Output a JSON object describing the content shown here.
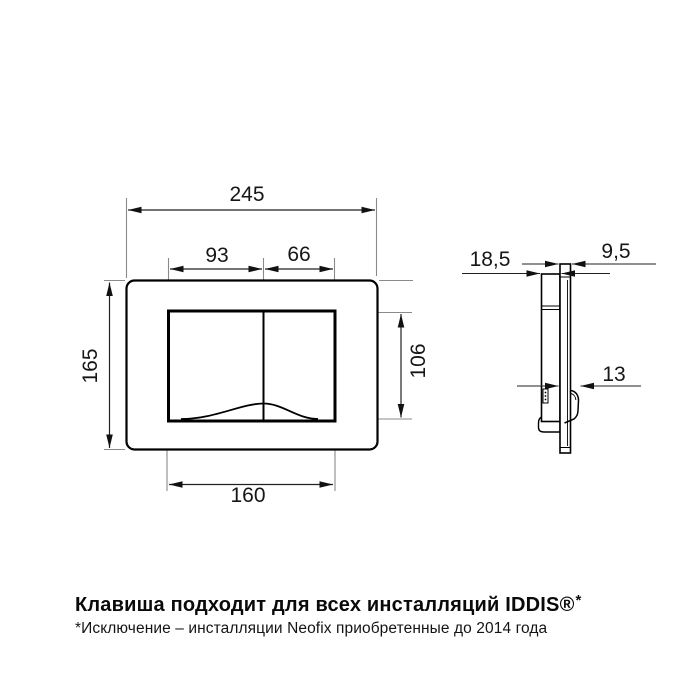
{
  "front_view": {
    "dim_width": "245",
    "dim_height": "165",
    "dim_button_left": "93",
    "dim_button_right": "66",
    "dim_button_height": "106",
    "dim_button_width": "160"
  },
  "side_view": {
    "dim_depth": "18,5",
    "dim_plate_thickness": "9,5",
    "dim_button_depth": "13"
  },
  "caption": {
    "heading": "Клавиша подходит для всех инсталляций IDDIS®",
    "heading_star": "*",
    "footnote": "*Исключение – инсталляции Neofix приобретенные до 2014 года"
  },
  "colors": {
    "outline": "#000000",
    "dimension_line": "#222222",
    "extension_line": "#8a8a8a",
    "text": "#161616"
  }
}
